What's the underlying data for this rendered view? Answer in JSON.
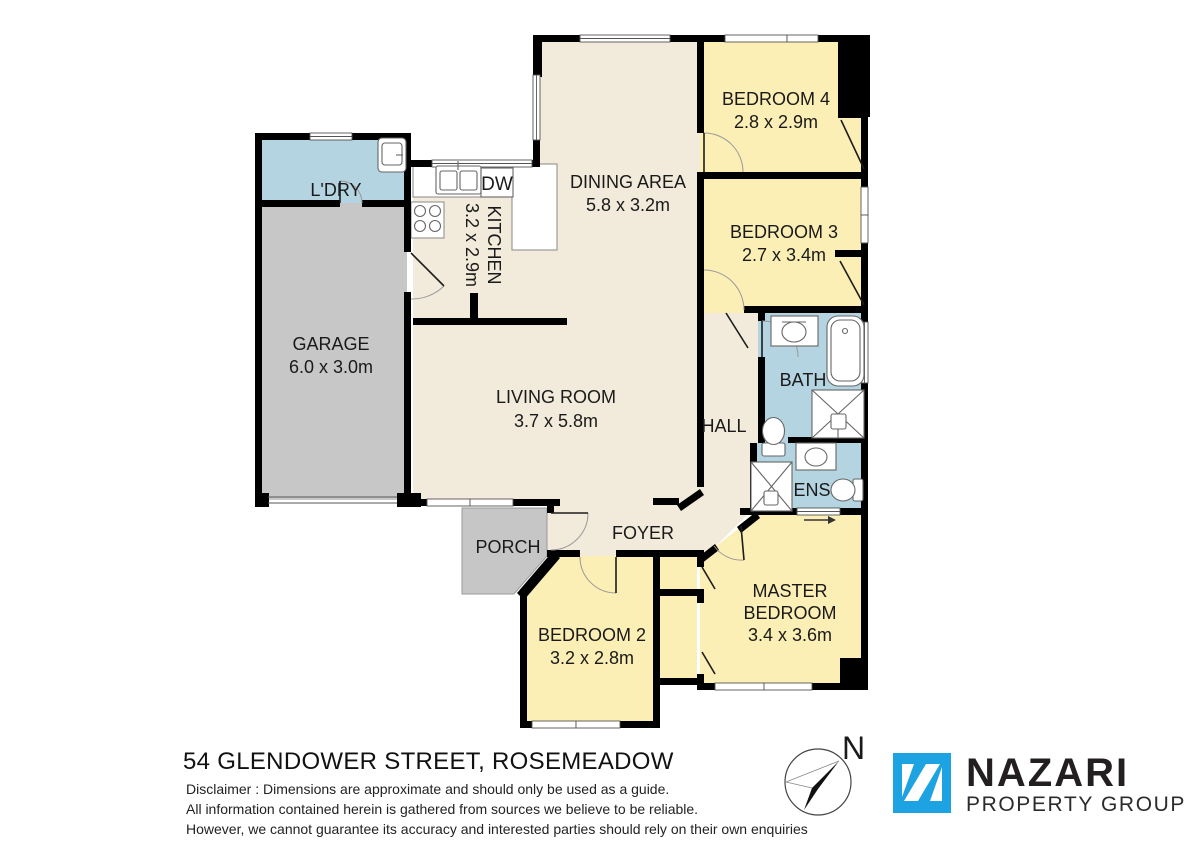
{
  "plan": {
    "rooms": {
      "ldry": {
        "label": "L'DRY"
      },
      "garage": {
        "label": "GARAGE",
        "dims": "6.0 x 3.0m"
      },
      "kitchen": {
        "label": "KITCHEN",
        "dims": "3.2 x 2.9m"
      },
      "dining": {
        "label": "DINING AREA",
        "dims": "5.8 x 3.2m"
      },
      "bedroom4": {
        "label": "BEDROOM 4",
        "dims": "2.8 x 2.9m"
      },
      "bedroom3": {
        "label": "BEDROOM 3",
        "dims": "2.7 x 3.4m"
      },
      "bath": {
        "label": "BATH"
      },
      "hall": {
        "label": "HALL"
      },
      "ens": {
        "label": "ENS"
      },
      "living": {
        "label": "LIVING ROOM",
        "dims": "3.7 x 5.8m"
      },
      "foyer": {
        "label": "FOYER"
      },
      "porch": {
        "label": "PORCH"
      },
      "bedroom2": {
        "label": "BEDROOM 2",
        "dims": "3.2 x 2.8m"
      },
      "master": {
        "label1": "MASTER",
        "label2": "BEDROOM",
        "dims": "3.4 x 3.6m"
      }
    },
    "appliances": {
      "dishwasher": "DW"
    },
    "compass": {
      "north": "N"
    }
  },
  "footer": {
    "address": "54 GLENDOWER STREET, ROSEMEADOW",
    "disclaimer": [
      "Disclaimer : Dimensions are approximate and should only be used as a guide.",
      "All information contained herein is gathered from sources we believe to be reliable.",
      "However, we cannot guarantee its accuracy and interested parties should rely on their own enquiries"
    ]
  },
  "logo": {
    "name": "NAZARI",
    "tagline": "PROPERTY GROUP"
  },
  "colors": {
    "floor_cream": "#F2EBDB",
    "bedroom_yellow": "#FCEFB6",
    "wet_area_blue": "#B3D4E0",
    "garage_grey": "#C7C7C7",
    "wall_black": "#000000",
    "brand_blue": "#1EA3E2"
  }
}
